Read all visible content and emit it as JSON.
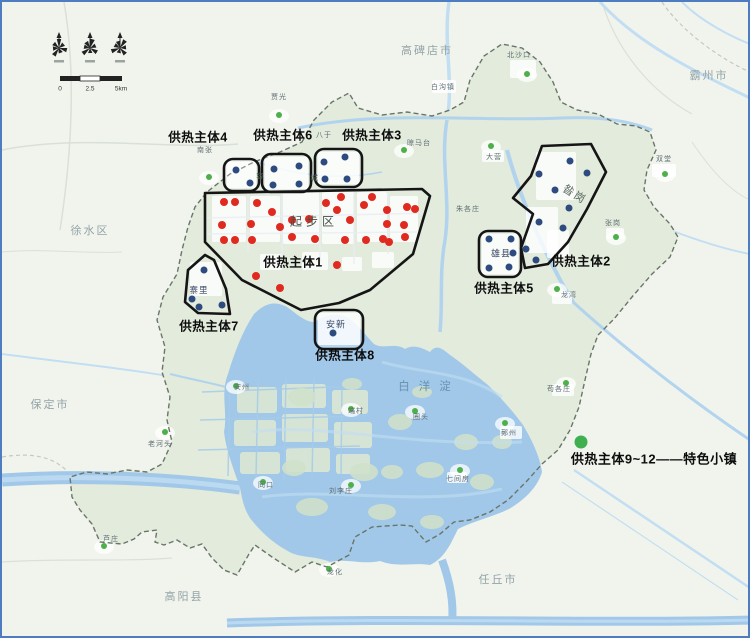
{
  "canvas": {
    "width": 750,
    "height": 638,
    "frame_color": "#4d7cc0",
    "bg_outside": "#f1f4ed",
    "bg_area": "#e2ebdc",
    "lake_color": "#a1c8e8",
    "water_light": "#c2def2"
  },
  "compass": {
    "rose_count": 3,
    "rose_icon": "wind-rose"
  },
  "scalebar": {
    "labels": [
      "0",
      "2.5",
      "5km"
    ],
    "label_x": [
      58,
      88,
      119
    ],
    "label_y": 87
  },
  "legend": {
    "text": "供热主体9~12——特色小镇",
    "dot_color": "#3faf4f",
    "dot": {
      "x": 579,
      "y": 440,
      "r": 6.5
    },
    "text_pos": {
      "x": 652,
      "y": 456
    }
  },
  "labels": {
    "cities": [
      {
        "text": "高碑店市",
        "x": 425,
        "y": 48
      },
      {
        "text": "霸州市",
        "x": 707,
        "y": 73
      },
      {
        "text": "徐水区",
        "x": 88,
        "y": 228
      },
      {
        "text": "保定市",
        "x": 48,
        "y": 402
      },
      {
        "text": "高阳县",
        "x": 182,
        "y": 594
      },
      {
        "text": "任丘市",
        "x": 496,
        "y": 577
      }
    ],
    "towns": [
      {
        "text": "白沟镇",
        "x": 441,
        "y": 85
      },
      {
        "text": "北沙口",
        "x": 517,
        "y": 53
      },
      {
        "text": "双堂",
        "x": 662,
        "y": 157
      },
      {
        "text": "大营",
        "x": 492,
        "y": 155
      },
      {
        "text": "晾马台",
        "x": 417,
        "y": 141
      },
      {
        "text": "朱各庄",
        "x": 466,
        "y": 207
      },
      {
        "text": "八于",
        "x": 322,
        "y": 133
      },
      {
        "text": "贾光",
        "x": 277,
        "y": 95
      },
      {
        "text": "南张",
        "x": 203,
        "y": 148
      },
      {
        "text": "张岗",
        "x": 611,
        "y": 221
      },
      {
        "text": "龙湾",
        "x": 567,
        "y": 293
      },
      {
        "text": "苟各庄",
        "x": 557,
        "y": 387
      },
      {
        "text": "鄚州",
        "x": 507,
        "y": 431
      },
      {
        "text": "七间房",
        "x": 456,
        "y": 477
      },
      {
        "text": "圈头",
        "x": 419,
        "y": 415
      },
      {
        "text": "端村",
        "x": 354,
        "y": 409
      },
      {
        "text": "安州",
        "x": 240,
        "y": 385
      },
      {
        "text": "老河头",
        "x": 158,
        "y": 442
      },
      {
        "text": "同口",
        "x": 264,
        "y": 483
      },
      {
        "text": "刘李庄",
        "x": 339,
        "y": 489
      },
      {
        "text": "龙化",
        "x": 333,
        "y": 570
      },
      {
        "text": "芦庄",
        "x": 109,
        "y": 537
      }
    ],
    "areas": [
      {
        "text": "起步区",
        "x": 312,
        "y": 219,
        "cls": "a-qibu"
      },
      {
        "text": "昝岗",
        "x": 573,
        "y": 192,
        "cls": "a-zangang"
      },
      {
        "text": "雄县",
        "x": 499,
        "y": 251,
        "cls": "a-xiong"
      },
      {
        "text": "安新",
        "x": 334,
        "y": 322,
        "cls": "a-anxin"
      },
      {
        "text": "寨里",
        "x": 197,
        "y": 288,
        "cls": "a-zhaili"
      },
      {
        "text": "白洋淀",
        "x": 427,
        "y": 384,
        "cls": "a-lake"
      }
    ],
    "split_chars": [
      {
        "text": "容",
        "x": 258,
        "y": 174,
        "cls": "a-split"
      },
      {
        "text": "城",
        "x": 312,
        "y": 176,
        "cls": "a-split"
      }
    ]
  },
  "zones": [
    {
      "num": "1",
      "label": "供热主体1",
      "label_x": 291,
      "label_y": 259,
      "shape": "polygon",
      "points": [
        [
          203,
          191
        ],
        [
          420,
          187
        ],
        [
          428,
          194
        ],
        [
          411,
          252
        ],
        [
          368,
          288
        ],
        [
          337,
          301
        ],
        [
          299,
          308
        ],
        [
          240,
          278
        ],
        [
          203,
          240
        ]
      ]
    },
    {
      "num": "2",
      "label": "供热主体2",
      "label_x": 579,
      "label_y": 258,
      "shape": "polygon",
      "points": [
        [
          540,
          144
        ],
        [
          589,
          142
        ],
        [
          604,
          170
        ],
        [
          585,
          207
        ],
        [
          566,
          240
        ],
        [
          546,
          262
        ],
        [
          523,
          266
        ],
        [
          519,
          246
        ],
        [
          531,
          212
        ],
        [
          511,
          196
        ],
        [
          529,
          174
        ]
      ]
    },
    {
      "num": "3",
      "label": "供热主体3",
      "label_x": 370,
      "label_y": 132,
      "shape": "rect",
      "x": 313,
      "y": 147,
      "w": 47,
      "h": 38
    },
    {
      "num": "4",
      "label": "供热主体4",
      "label_x": 196,
      "label_y": 134,
      "shape": "rect",
      "x": 222,
      "y": 157,
      "w": 35,
      "h": 32
    },
    {
      "num": "5",
      "label": "供热主体5",
      "label_x": 502,
      "label_y": 285,
      "shape": "rect",
      "x": 477,
      "y": 229,
      "w": 42,
      "h": 46
    },
    {
      "num": "6",
      "label": "供热主体6",
      "label_x": 281,
      "label_y": 132,
      "shape": "rect",
      "x": 260,
      "y": 152,
      "w": 49,
      "h": 38
    },
    {
      "num": "7",
      "label": "供热主体7",
      "label_x": 207,
      "label_y": 323,
      "shape": "polygon",
      "points": [
        [
          203,
          253
        ],
        [
          186,
          268
        ],
        [
          183,
          300
        ],
        [
          196,
          311
        ],
        [
          228,
          312
        ],
        [
          224,
          287
        ],
        [
          212,
          258
        ]
      ]
    },
    {
      "num": "8",
      "label": "供热主体8",
      "label_x": 343,
      "label_y": 352,
      "shape": "rect",
      "x": 313,
      "y": 308,
      "w": 48,
      "h": 39
    }
  ],
  "dots": {
    "red_color": "#e02a20",
    "blue_color": "#2d4b7e",
    "green_color": "#4db04a",
    "red": [
      [
        222,
        200
      ],
      [
        233,
        200
      ],
      [
        255,
        201
      ],
      [
        270,
        210
      ],
      [
        249,
        222
      ],
      [
        220,
        223
      ],
      [
        222,
        238
      ],
      [
        233,
        238
      ],
      [
        250,
        238
      ],
      [
        278,
        225
      ],
      [
        290,
        218
      ],
      [
        307,
        217
      ],
      [
        290,
        235
      ],
      [
        313,
        237
      ],
      [
        324,
        201
      ],
      [
        339,
        195
      ],
      [
        335,
        208
      ],
      [
        348,
        218
      ],
      [
        362,
        203
      ],
      [
        370,
        195
      ],
      [
        381,
        237
      ],
      [
        364,
        238
      ],
      [
        343,
        238
      ],
      [
        385,
        208
      ],
      [
        405,
        205
      ],
      [
        413,
        207
      ],
      [
        385,
        222
      ],
      [
        402,
        223
      ],
      [
        403,
        235
      ],
      [
        387,
        240
      ],
      [
        335,
        263
      ],
      [
        254,
        274
      ],
      [
        278,
        286
      ]
    ],
    "blue": [
      [
        234,
        168
      ],
      [
        248,
        181
      ],
      [
        272,
        167
      ],
      [
        297,
        164
      ],
      [
        271,
        183
      ],
      [
        297,
        182
      ],
      [
        322,
        160
      ],
      [
        343,
        155
      ],
      [
        323,
        177
      ],
      [
        345,
        177
      ],
      [
        202,
        268
      ],
      [
        190,
        297
      ],
      [
        197,
        305
      ],
      [
        220,
        303
      ],
      [
        331,
        331
      ],
      [
        487,
        237
      ],
      [
        509,
        237
      ],
      [
        487,
        266
      ],
      [
        507,
        265
      ],
      [
        511,
        251
      ],
      [
        568,
        159
      ],
      [
        585,
        171
      ],
      [
        537,
        172
      ],
      [
        553,
        188
      ],
      [
        567,
        206
      ],
      [
        561,
        226
      ],
      [
        537,
        220
      ],
      [
        524,
        247
      ],
      [
        534,
        258
      ]
    ],
    "green": [
      [
        207,
        175
      ],
      [
        277,
        113
      ],
      [
        525,
        72
      ],
      [
        663,
        172
      ],
      [
        489,
        144
      ],
      [
        402,
        148
      ],
      [
        614,
        235
      ],
      [
        555,
        287
      ],
      [
        564,
        381
      ],
      [
        503,
        421
      ],
      [
        458,
        468
      ],
      [
        413,
        409
      ],
      [
        349,
        407
      ],
      [
        234,
        384
      ],
      [
        163,
        430
      ],
      [
        261,
        480
      ],
      [
        349,
        483
      ],
      [
        327,
        567
      ],
      [
        102,
        544
      ]
    ]
  }
}
